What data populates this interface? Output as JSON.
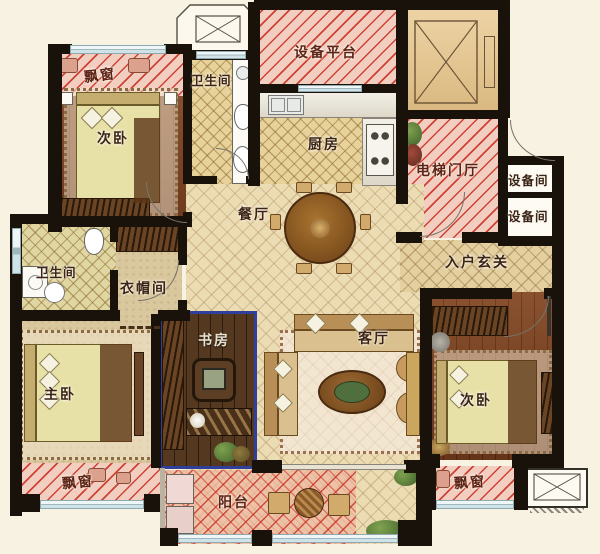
{
  "rooms": {
    "bay_window_top_left": "飘窗",
    "bedroom_top_left": "次卧",
    "bathroom_top": "卫生间",
    "equipment_platform": "设备平台",
    "kitchen": "厨房",
    "elevator_hall": "电梯门厅",
    "equipment_room_1": "设备间",
    "equipment_room_2": "设备间",
    "dining_room": "餐厅",
    "entrance_foyer": "入户玄关",
    "bathroom_left": "卫生间",
    "cloakroom": "衣帽间",
    "study": "书房",
    "living_room": "客厅",
    "master_bedroom": "主卧",
    "bedroom_right": "次卧",
    "bay_window_bottom_left": "飘窗",
    "balcony": "阳台",
    "bay_window_bottom_right": "飘窗"
  },
  "colors": {
    "wall": "#18120b",
    "hatch_red": "#c8392b",
    "highlight_blue": "#2f3f9c",
    "background": "#f8f2e3",
    "wood_floor": "#7e4220",
    "tile_floor": "#ecdcb4"
  }
}
